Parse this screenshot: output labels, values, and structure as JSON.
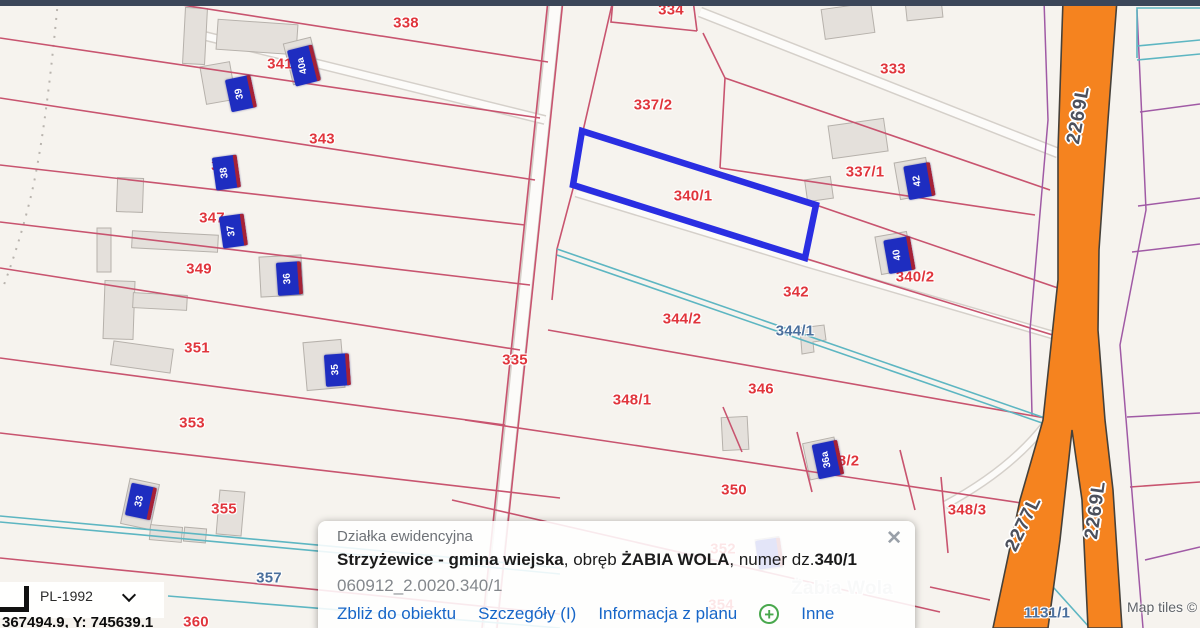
{
  "map": {
    "parcel_labels": [
      {
        "text": "338",
        "x": 406,
        "y": 23,
        "color": "red"
      },
      {
        "text": "341",
        "x": 280,
        "y": 64,
        "color": "red"
      },
      {
        "text": "334",
        "x": 671,
        "y": 10,
        "color": "red"
      },
      {
        "text": "333",
        "x": 893,
        "y": 69,
        "color": "red"
      },
      {
        "text": "343",
        "x": 322,
        "y": 139,
        "color": "red"
      },
      {
        "text": "337/2",
        "x": 653,
        "y": 105,
        "color": "red"
      },
      {
        "text": "345",
        "x": 224,
        "y": 166,
        "color": "red"
      },
      {
        "text": "347",
        "x": 212,
        "y": 218,
        "color": "red"
      },
      {
        "text": "337/1",
        "x": 865,
        "y": 172,
        "color": "red"
      },
      {
        "text": "340/1",
        "x": 693,
        "y": 196,
        "color": "red"
      },
      {
        "text": "349",
        "x": 199,
        "y": 269,
        "color": "red"
      },
      {
        "text": "340/2",
        "x": 915,
        "y": 277,
        "color": "red"
      },
      {
        "text": "342",
        "x": 796,
        "y": 292,
        "color": "red"
      },
      {
        "text": "344/2",
        "x": 682,
        "y": 319,
        "color": "red"
      },
      {
        "text": "344/1",
        "x": 795,
        "y": 331,
        "color": "bluegray"
      },
      {
        "text": "335",
        "x": 515,
        "y": 360,
        "color": "red"
      },
      {
        "text": "351",
        "x": 197,
        "y": 348,
        "color": "red"
      },
      {
        "text": "348/1",
        "x": 632,
        "y": 400,
        "color": "red"
      },
      {
        "text": "346",
        "x": 761,
        "y": 389,
        "color": "red"
      },
      {
        "text": "353",
        "x": 192,
        "y": 423,
        "color": "red"
      },
      {
        "text": "350",
        "x": 734,
        "y": 490,
        "color": "red"
      },
      {
        "text": "348/2",
        "x": 840,
        "y": 461,
        "color": "red"
      },
      {
        "text": "355",
        "x": 224,
        "y": 509,
        "color": "red"
      },
      {
        "text": "348/3",
        "x": 967,
        "y": 510,
        "color": "red"
      },
      {
        "text": "357",
        "x": 269,
        "y": 578,
        "color": "bluegray"
      },
      {
        "text": "352",
        "x": 723,
        "y": 549,
        "color": "red"
      },
      {
        "text": "354",
        "x": 721,
        "y": 605,
        "color": "red"
      },
      {
        "text": "360",
        "x": 196,
        "y": 622,
        "color": "red"
      },
      {
        "text": "1131/1",
        "x": 1047,
        "y": 613,
        "color": "bluegray"
      },
      {
        "text": "Żabia Wola",
        "x": 842,
        "y": 589,
        "color": "gray",
        "size": 19
      }
    ],
    "building_markers": [
      {
        "text": "40a",
        "x": 291,
        "y": 47,
        "w": 22,
        "h": 37,
        "rot": -14
      },
      {
        "text": "39",
        "x": 228,
        "y": 77,
        "w": 22,
        "h": 33,
        "rot": -12
      },
      {
        "text": "38",
        "x": 214,
        "y": 156,
        "w": 21,
        "h": 33,
        "rot": -8
      },
      {
        "text": "37",
        "x": 221,
        "y": 215,
        "w": 21,
        "h": 32,
        "rot": -8
      },
      {
        "text": "36",
        "x": 277,
        "y": 262,
        "w": 21,
        "h": 33,
        "rot": -4
      },
      {
        "text": "35",
        "x": 325,
        "y": 354,
        "w": 21,
        "h": 32,
        "rot": -4
      },
      {
        "text": "33",
        "x": 128,
        "y": 485,
        "w": 22,
        "h": 33,
        "rot": 12
      },
      {
        "text": "42",
        "x": 906,
        "y": 164,
        "w": 23,
        "h": 34,
        "rot": -10
      },
      {
        "text": "40",
        "x": 886,
        "y": 238,
        "w": 23,
        "h": 34,
        "rot": -10
      },
      {
        "text": "36a",
        "x": 815,
        "y": 442,
        "w": 22,
        "h": 35,
        "rot": -12
      },
      {
        "text": "",
        "x": 757,
        "y": 539,
        "w": 21,
        "h": 29,
        "rot": -8
      }
    ],
    "road_labels": [
      {
        "text": "2269L",
        "x": 1079,
        "y": 115,
        "rot": -80
      },
      {
        "text": "2269L",
        "x": 1096,
        "y": 510,
        "rot": -82
      },
      {
        "text": "2277L",
        "x": 1024,
        "y": 524,
        "rot": -64
      }
    ],
    "credit": "Map tiles ©"
  },
  "popup": {
    "title": "Działka ewidencyjna",
    "line1_bold1": "Strzyżewice - gmina wiejska",
    "line1_sep1": ", obręb ",
    "line1_bold2": "ŻABIA WOLA",
    "line1_sep2": ", numer dz.",
    "line1_bold3": "340/1",
    "id_line": "060912_2.0020.340/1",
    "links": [
      "Zbliż do obiektu",
      "Szczegóły (I)",
      "Informacja z planu",
      "Inne"
    ],
    "plus_symbol": "+",
    "close_icon": "✕"
  },
  "coord_widget": {
    "crs": "PL-1992",
    "coords": "367494.9,  Y: 745639.1"
  },
  "colors": {
    "selection_blue": "#2a2ee2",
    "parcel_label_red": "#e0353c",
    "parcel_line_red": "#c8546f",
    "road_orange": "#f5831f",
    "ditch_teal": "#5db6c2",
    "boundary_purple": "#a05aa5",
    "marker_blue": "#1e2dc0"
  }
}
